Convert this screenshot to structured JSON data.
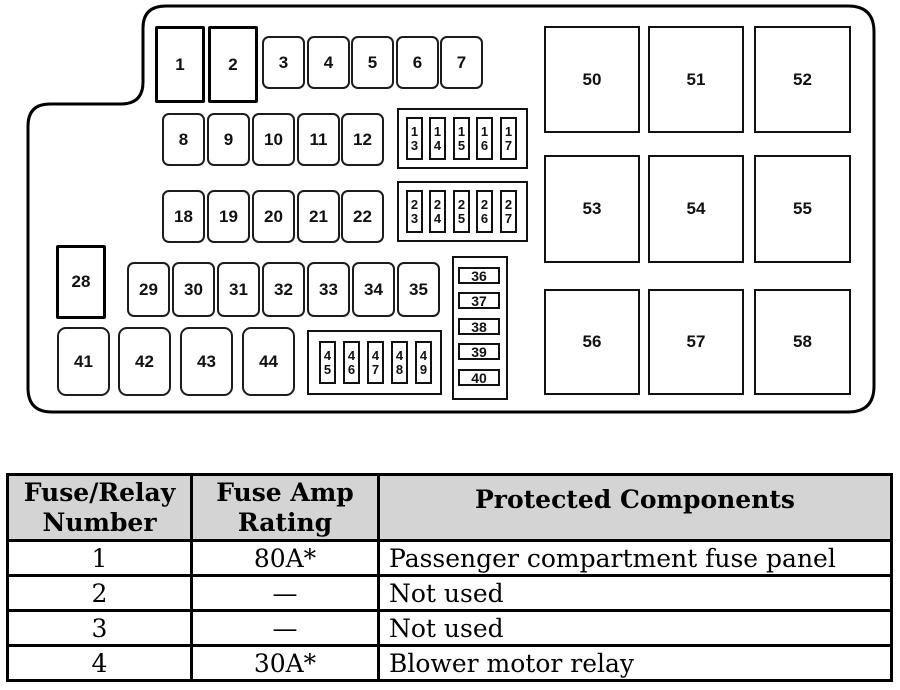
{
  "diagram": {
    "relays_top": [
      "1",
      "2"
    ],
    "row_3_7": [
      "3",
      "4",
      "5",
      "6",
      "7"
    ],
    "row_8_12": [
      "8",
      "9",
      "10",
      "11",
      "12"
    ],
    "group_13_17": [
      "1\n3",
      "1\n4",
      "1\n5",
      "1\n6",
      "1\n7"
    ],
    "row_18_22": [
      "18",
      "19",
      "20",
      "21",
      "22"
    ],
    "group_23_27": [
      "2\n3",
      "2\n4",
      "2\n5",
      "2\n6",
      "2\n7"
    ],
    "relay_28": "28",
    "row_29_35": [
      "29",
      "30",
      "31",
      "32",
      "33",
      "34",
      "35"
    ],
    "column_36_40": [
      "36",
      "37",
      "38",
      "39",
      "40"
    ],
    "row_41_44": [
      "41",
      "42",
      "43",
      "44"
    ],
    "group_45_49": [
      "4\n5",
      "4\n6",
      "4\n7",
      "4\n8",
      "4\n9"
    ],
    "squares_50_58": [
      "50",
      "51",
      "52",
      "53",
      "54",
      "55",
      "56",
      "57",
      "58"
    ]
  },
  "table": {
    "headers": {
      "number": "Fuse/Relay\nNumber",
      "rating": "Fuse Amp\nRating",
      "components": "Protected Components"
    },
    "rows": [
      {
        "number": "1",
        "rating": "80A*",
        "component": "Passenger compartment fuse panel"
      },
      {
        "number": "2",
        "rating": "—",
        "component": "Not used"
      },
      {
        "number": "3",
        "rating": "—",
        "component": "Not used"
      },
      {
        "number": "4",
        "rating": "30A*",
        "component": "Blower motor relay"
      }
    ]
  },
  "colors": {
    "line": "#000000",
    "header_bg": "#d4d4d4",
    "background": "#ffffff"
  }
}
